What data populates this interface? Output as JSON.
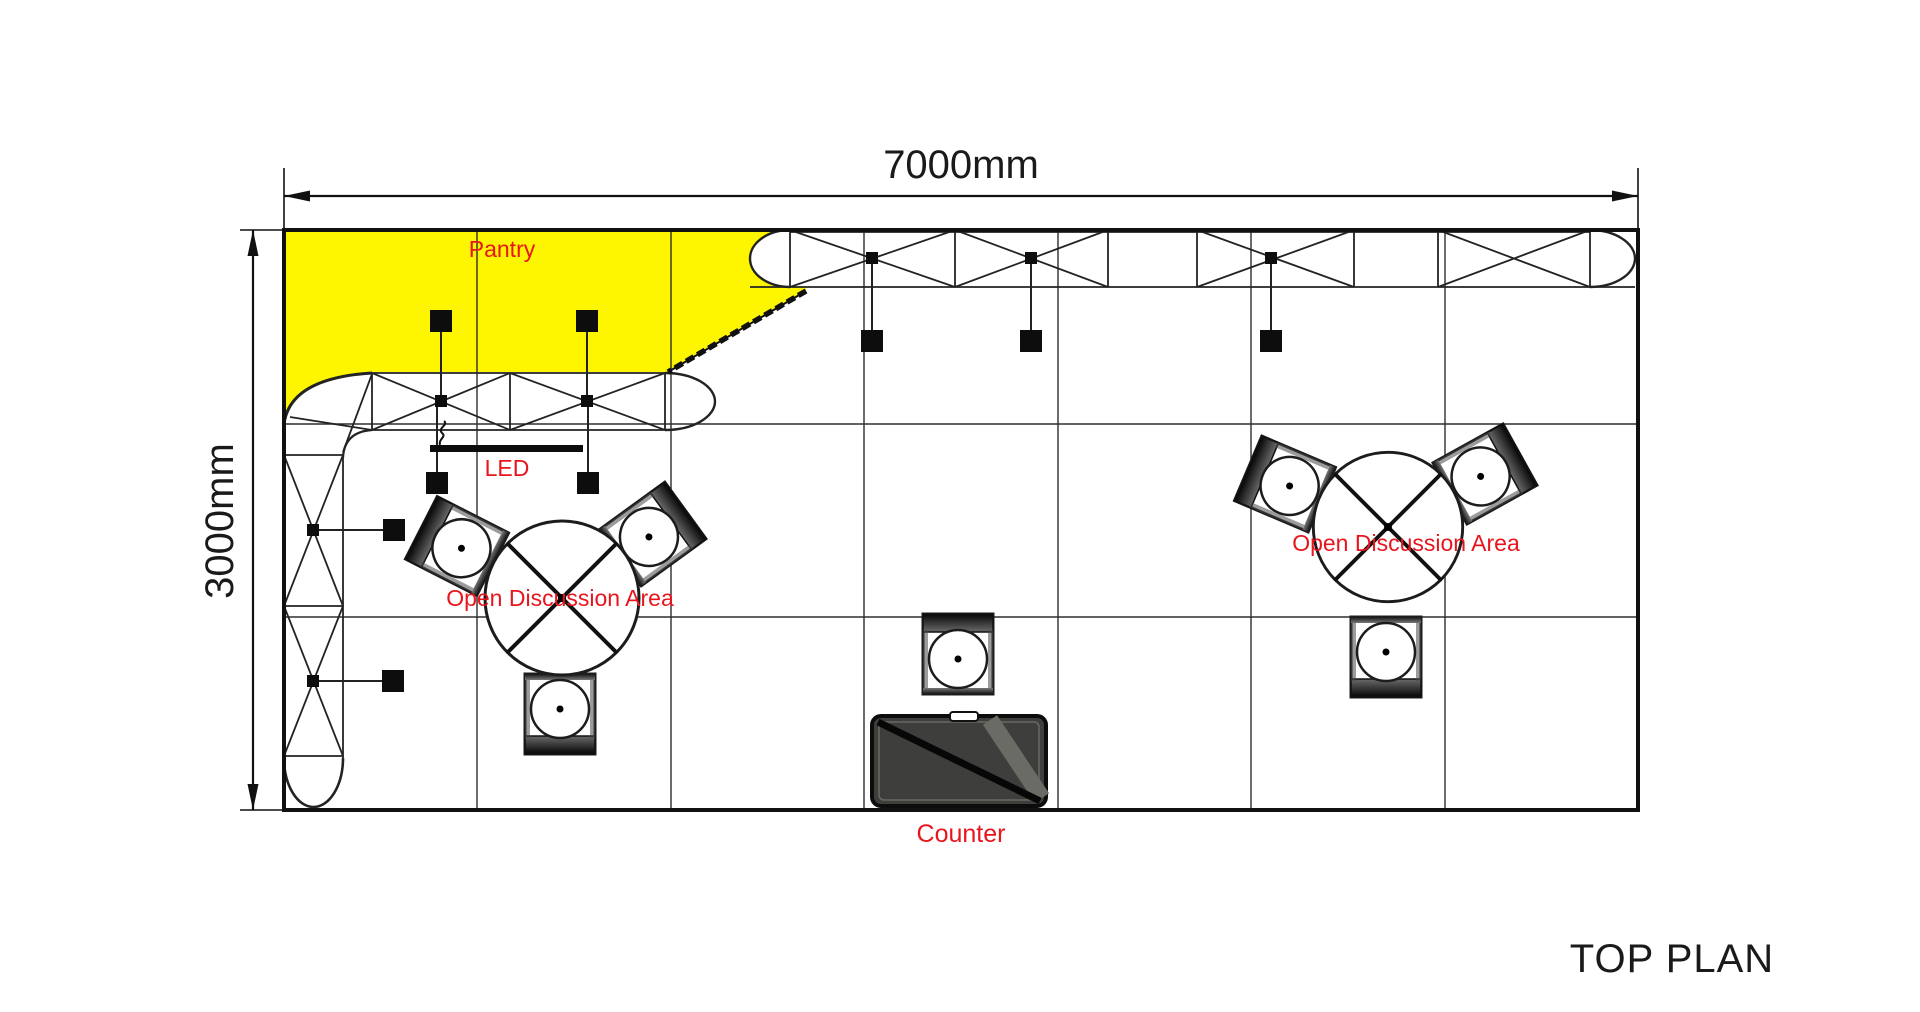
{
  "title": "TOP PLAN",
  "dimensions": {
    "width": "7000mm",
    "height": "3000mm"
  },
  "labels": {
    "pantry": "Pantry",
    "led": "LED",
    "open_discussion_left": "Open Discussion Area",
    "open_discussion_right": "Open Discussion Area",
    "counter": "Counter"
  },
  "colors": {
    "pantry_highlight": "#FEF600",
    "annotation_red": "#E8151D",
    "linework": "#1C1C1C",
    "counter_fill": "#3E3E3C",
    "background": "#FFFFFF"
  }
}
